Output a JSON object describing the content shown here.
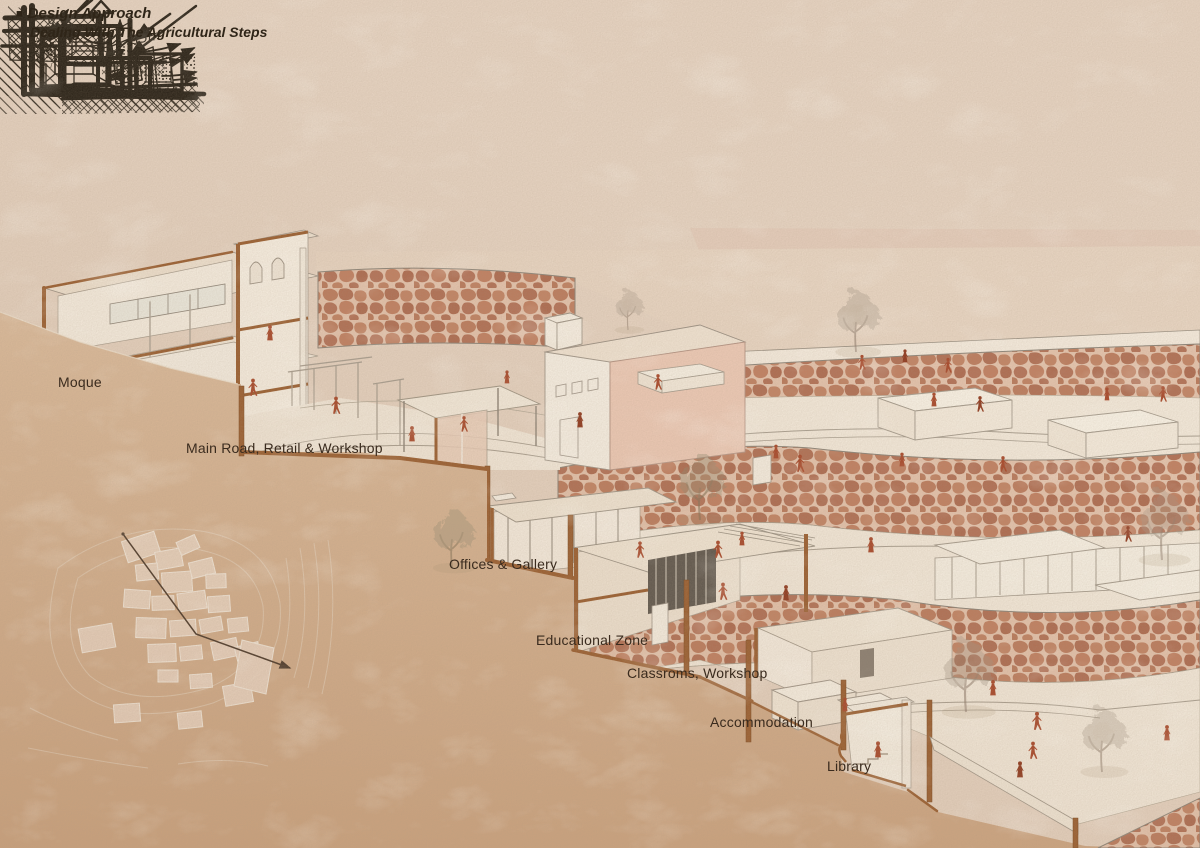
{
  "board": {
    "bullet": "■",
    "title": "Design Approach",
    "subtitle": "Dealing With The Agricultural Steps"
  },
  "sketches": {
    "items": [
      {
        "name": "sunken-unit-cross-ventilation"
      },
      {
        "name": "raised-unit-stack-ventilation",
        "annotation": "0,5"
      },
      {
        "name": "agricultural-step-wall-height",
        "annotation": "2,5m"
      },
      {
        "name": "stepped-units-courtyard-tree"
      },
      {
        "name": "stacked-units-on-terraces"
      }
    ]
  },
  "diagram": {
    "labels": [
      {
        "id": "moque",
        "text": "Moque"
      },
      {
        "id": "main-road",
        "text": "Main Road, Retail & Workshop"
      },
      {
        "id": "offices",
        "text": "Offices & Gallery"
      },
      {
        "id": "educational",
        "text": "Educational Zone"
      },
      {
        "id": "classrooms",
        "text": "Classroms, Workshop"
      },
      {
        "id": "accommodation",
        "text": "Accommodation"
      },
      {
        "id": "library",
        "text": "Library"
      }
    ]
  },
  "colors": {
    "paper": "#e5d2c0",
    "hillside": "#d5b190",
    "terrace_floor": "#f2e8d9",
    "stone_wall": "#bb7c5e",
    "section_cut_brown": "#9a5f31",
    "figure_red": "#a8492b",
    "sketch_ink": "#2c2419",
    "label_text": "#3a2b1e"
  }
}
